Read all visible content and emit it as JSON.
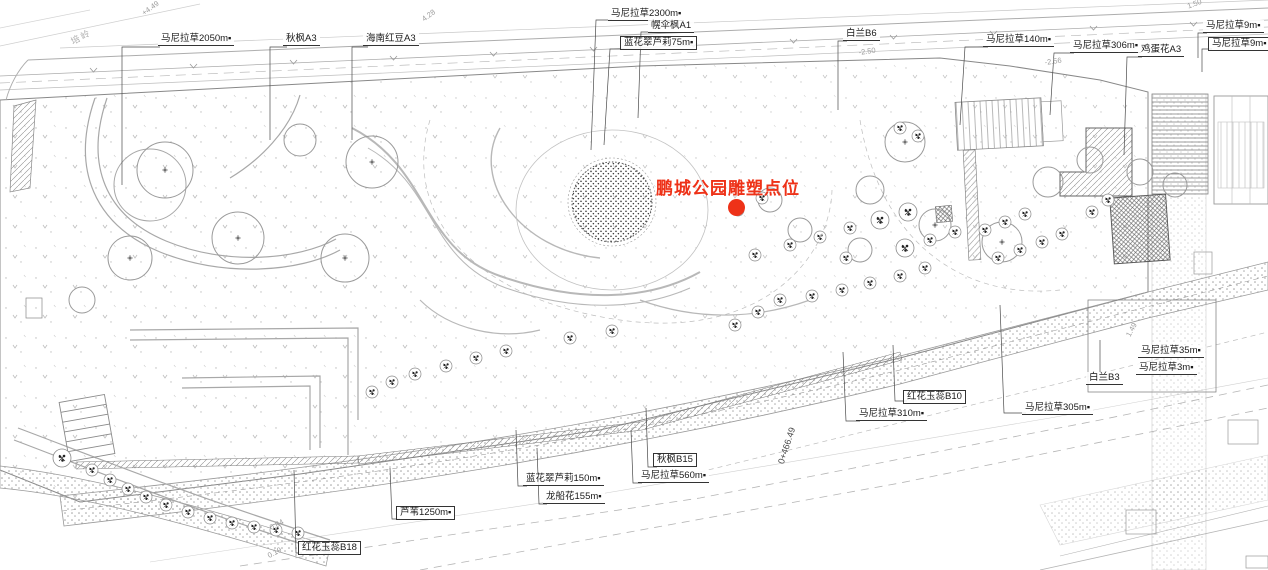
{
  "annotation": {
    "title": "鹏城公园雕塑点位",
    "marker_color": "#ee3218"
  },
  "plant_labels": [
    {
      "text": "马尼拉草2050m▪"
    },
    {
      "text": "秋枫A3"
    },
    {
      "text": "海南红豆A3"
    },
    {
      "text": "马尼拉草2300m▪"
    },
    {
      "text": "幌伞枫A1"
    },
    {
      "text": "蓝花翠芦莉75m▪"
    },
    {
      "text": "白兰B6"
    },
    {
      "text": "马尼拉草140m▪"
    },
    {
      "text": "马尼拉草306m▪"
    },
    {
      "text": "鸡蛋花A3"
    },
    {
      "text": "马尼拉草9m▪"
    },
    {
      "text": "马尼拉草9m▪"
    },
    {
      "text": "马尼拉草35m▪"
    },
    {
      "text": "马尼拉草3m▪"
    },
    {
      "text": "白兰B3"
    },
    {
      "text": "马尼拉草305m▪"
    },
    {
      "text": "红花玉蕊B10"
    },
    {
      "text": "马尼拉草310m▪"
    },
    {
      "text": "秋枫B15"
    },
    {
      "text": "马尼拉草560m▪"
    },
    {
      "text": "蓝花翠芦莉150m▪"
    },
    {
      "text": "龙船花155m▪"
    },
    {
      "text": "芦苇1250m▪"
    },
    {
      "text": "红花玉蕊B18"
    }
  ],
  "station_label": {
    "text": "0+466.49"
  },
  "area_name": {
    "text": "培岭"
  },
  "elevation_marks": [
    {
      "text": "+4.49"
    },
    {
      "text": "4.28"
    },
    {
      "text": "-2.50"
    },
    {
      "text": "-2.56"
    },
    {
      "text": "1.50"
    },
    {
      "text": "0.84"
    },
    {
      "text": "0.19"
    },
    {
      "text": "1.49"
    }
  ],
  "colors": {
    "annotation_red": "#ee3218",
    "line_gray": "#9a9a9a",
    "dark_line": "#444444",
    "text_dark": "#1a1a1a",
    "hatch_dark": "#666666"
  }
}
